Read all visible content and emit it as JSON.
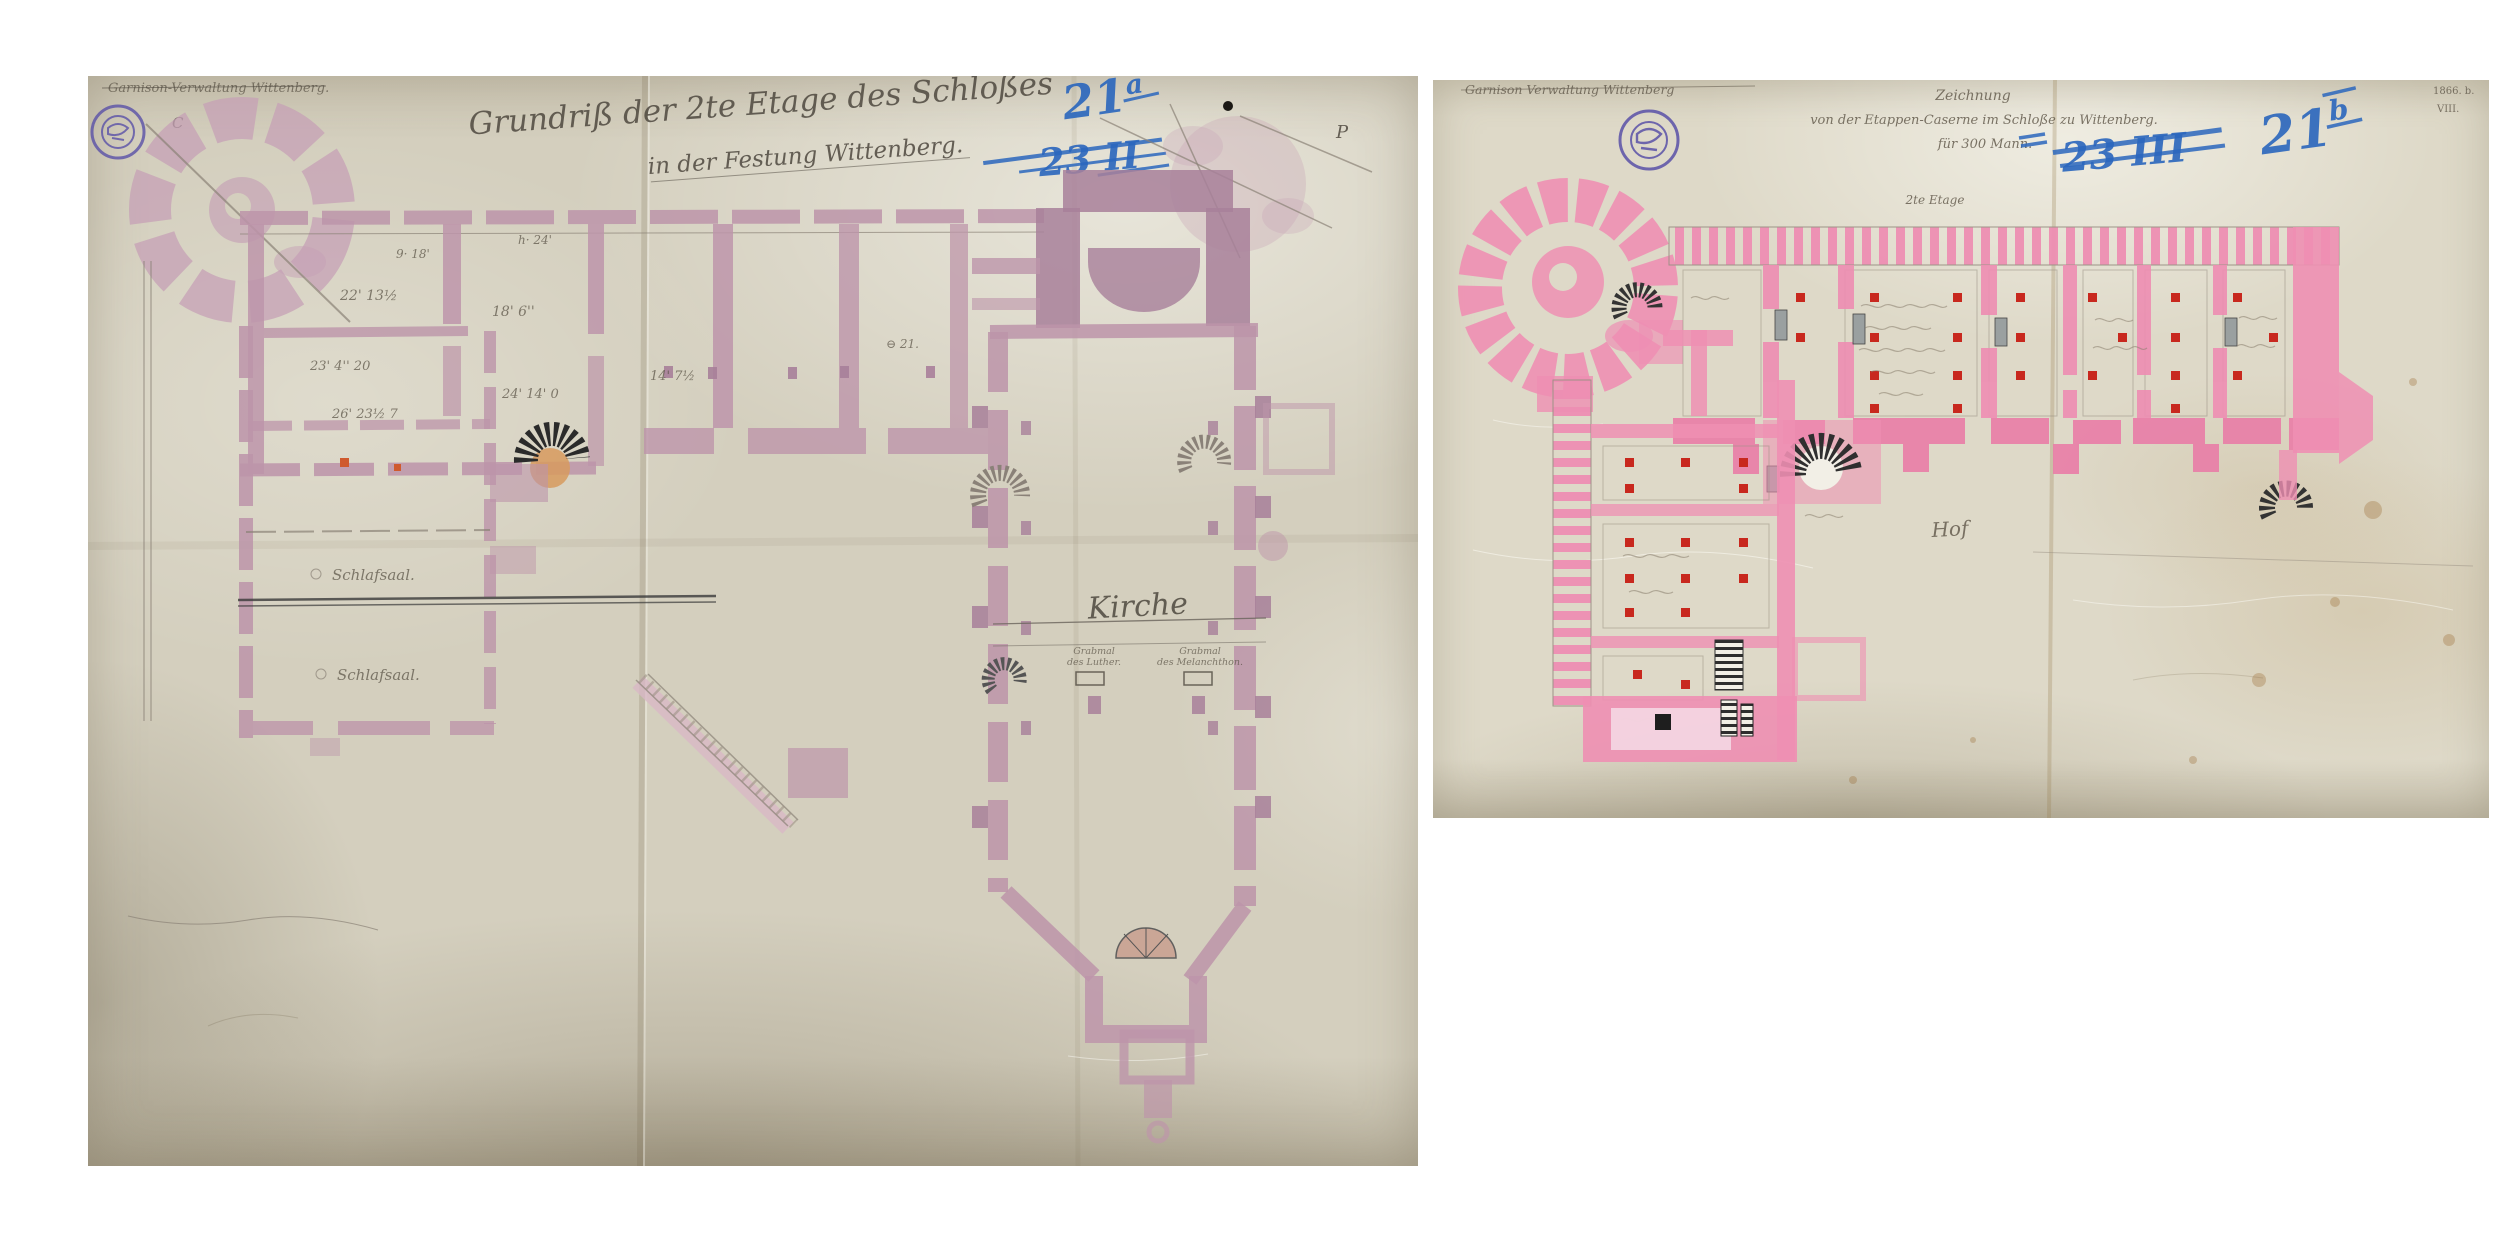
{
  "photo_left": {
    "corner_note": "Garnison-Verwaltung Wittenberg.",
    "corner_letter_c": "C",
    "corner_letter_p": "P",
    "title_line1": "Grundriß der 2te Etage des Schloßes",
    "title_line2": "in der Festung Wittenberg.",
    "blue_new_number": "21",
    "blue_new_suffix": "a",
    "blue_old_number": "23 II",
    "label_kirche": "Kirche",
    "label_schlafsaal_upper": "Schlafsaal.",
    "label_schlafsaal_lower": "Schlafsaal.",
    "grabmal_luther_line1": "Grabmal",
    "grabmal_luther_line2": "des Luther.",
    "grabmal_melanchthon_line1": "Grabmal",
    "grabmal_melanchthon_line2": "des Melanchthon.",
    "dim_marks": [
      "9· 18'",
      "h· 24'",
      "22' 13½",
      "18' 6''",
      "23' 4'' 20",
      "26' 23½ 7",
      "24' 14' 0",
      "14' 7½",
      "⊖ 21."
    ]
  },
  "photo_right": {
    "corner_note": "Garnison Verwaltung Wittenberg",
    "archive_mark_line1": "1866. b.",
    "archive_mark_line2": "VIII.",
    "title_line1": "Zeichnung",
    "title_line2": "von der Etappen-Caserne im Schloße zu Wittenberg.",
    "title_line3": "für 300 Mann.",
    "subtitle": "2te Etage",
    "blue_new_number": "21",
    "blue_new_suffix": "b",
    "blue_old_number": "23 III",
    "label_hof": "Hof"
  },
  "palette": {
    "left_wall": "#bd95aa",
    "left_wall_deep": "#a8809a",
    "right_wall": "#ee8fb3",
    "right_wall_deep": "#e97fa8",
    "blue_pencil": "#2a66bd",
    "stamp_violet": "#5a51a8",
    "red_accent": "#c8281e"
  }
}
